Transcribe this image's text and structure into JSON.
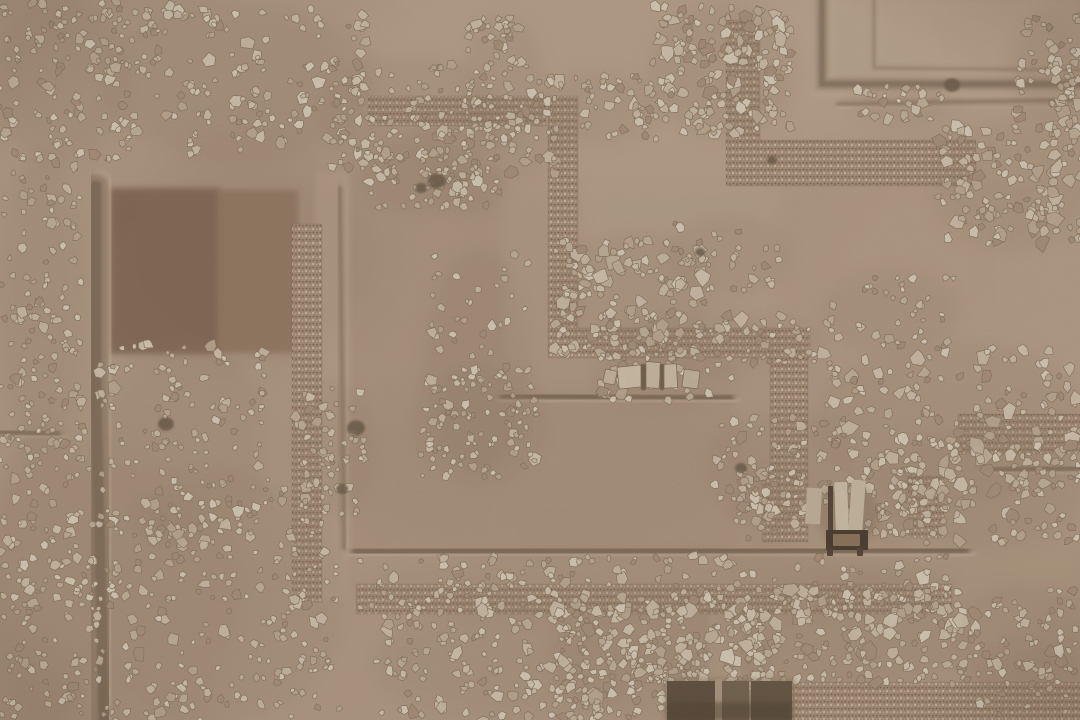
{
  "scene": {
    "description": "Aerial orthographic photograph of an archaeological excavation: tan earth, shallow trenches, pebble wall foundations, rubble fields, stone slabs, a small timber installation and a dark rectangular pit",
    "canvas": {
      "width": 1080,
      "height": 720
    },
    "palette": {
      "base": "#b59b84",
      "trench_dark": "#7c6450",
      "trench_core": "#6a5542",
      "trench_light": "#cbb296",
      "pebble_base": "#a68b72",
      "pebble_dark": "#8c7159",
      "pebble_light": "#cdb99e",
      "stone_stroke": "#857058",
      "dark_stone": "#6b5642",
      "pit_dark": "#584634",
      "wood_dark": "#3c2e1f"
    },
    "stone_palette": [
      "#d8c8b1",
      "#cfbda5",
      "#e0d2bc",
      "#c6b299",
      "#bfa98f",
      "#d2c0a8",
      "#a78d74"
    ],
    "tones": [
      {
        "cx": 650,
        "cy": 60,
        "rx": 300,
        "ry": 120,
        "c": "#c6ad93",
        "o": 0.5
      },
      {
        "cx": 180,
        "cy": 80,
        "rx": 200,
        "ry": 95,
        "c": "#b29880",
        "o": 0.5
      },
      {
        "cx": 540,
        "cy": 470,
        "rx": 220,
        "ry": 95,
        "c": "#a98e76",
        "o": 0.45
      },
      {
        "cx": 900,
        "cy": 620,
        "rx": 260,
        "ry": 120,
        "c": "#b09478",
        "o": 0.4
      },
      {
        "cx": 80,
        "cy": 600,
        "rx": 170,
        "ry": 150,
        "c": "#a78d75",
        "o": 0.5
      },
      {
        "cx": 1000,
        "cy": 300,
        "rx": 180,
        "ry": 140,
        "c": "#bda389",
        "o": 0.5
      },
      {
        "cx": 420,
        "cy": 650,
        "rx": 200,
        "ry": 90,
        "c": "#b79c82",
        "o": 0.4
      },
      {
        "cx": 250,
        "cy": 255,
        "rx": 130,
        "ry": 105,
        "c": "#8f735a",
        "o": 0.3
      },
      {
        "cx": 940,
        "cy": 40,
        "rx": 200,
        "ry": 80,
        "c": "#c3aa90",
        "o": 0.5
      }
    ],
    "patches": [
      {
        "x": 110,
        "y": 188,
        "w": 110,
        "h": 166,
        "c": "#75573f",
        "o": 0.85,
        "b": 3
      },
      {
        "x": 218,
        "y": 190,
        "w": 80,
        "h": 163,
        "c": "#8a6a4f",
        "o": 0.8,
        "b": 3
      },
      {
        "x": 820,
        "y": 0,
        "w": 260,
        "h": 88,
        "c": "#c2a98e",
        "o": 0.65,
        "b": 4
      },
      {
        "x": 968,
        "y": 84,
        "w": 112,
        "h": 100,
        "c": "#bfa58b",
        "o": 0.5,
        "b": 4
      },
      {
        "x": 350,
        "y": 170,
        "w": 154,
        "h": 384,
        "c": "#aa8f77",
        "o": 0.45,
        "b": 6
      },
      {
        "x": 502,
        "y": 394,
        "w": 234,
        "h": 160,
        "c": "#aa8f77",
        "o": 0.45,
        "b": 6
      },
      {
        "x": 316,
        "y": 172,
        "w": 34,
        "h": 428,
        "c": "#c0a78d",
        "o": 0.5,
        "b": 3
      },
      {
        "x": 708,
        "y": 606,
        "w": 34,
        "h": 74,
        "c": "#bfa58b",
        "o": 0.7,
        "b": 2
      },
      {
        "x": 358,
        "y": 556,
        "w": 370,
        "h": 28,
        "c": "#b89e85",
        "o": 0.5,
        "b": 3
      },
      {
        "x": 580,
        "y": 118,
        "w": 200,
        "h": 215,
        "c": "#bfa68c",
        "o": 0.5,
        "b": 10
      },
      {
        "x": 780,
        "y": 190,
        "w": 240,
        "h": 140,
        "c": "#b89e85",
        "o": 0.4,
        "b": 10
      }
    ],
    "trenches": [
      {
        "p": [
          [
            0,
            172
          ],
          [
            500,
            172
          ]
        ],
        "w": 20,
        "o": 0.6
      },
      {
        "p": [
          [
            96,
            186
          ],
          [
            96,
            400
          ],
          [
            104,
            720
          ]
        ],
        "w": 24,
        "o": 0.55
      },
      {
        "p": [
          [
            352,
            0
          ],
          [
            352,
            168
          ]
        ],
        "w": 16,
        "o": 0.5
      },
      {
        "p": [
          [
            340,
            188
          ],
          [
            344,
            548
          ]
        ],
        "w": 8,
        "o": 0.3
      },
      {
        "p": [
          [
            503,
            160
          ],
          [
            503,
            396
          ]
        ],
        "w": 10,
        "o": 0.4
      },
      {
        "p": [
          [
            503,
            396
          ],
          [
            730,
            398
          ]
        ],
        "w": 11,
        "o": 0.55
      },
      {
        "p": [
          [
            732,
            398
          ],
          [
            732,
            548
          ]
        ],
        "w": 11,
        "o": 0.5
      },
      {
        "p": [
          [
            356,
            552
          ],
          [
            965,
            550
          ]
        ],
        "w": 13,
        "o": 0.55
      },
      {
        "p": [
          [
            963,
            548
          ],
          [
            963,
            656
          ]
        ],
        "w": 13,
        "o": 0.5
      },
      {
        "p": [
          [
            985,
            470
          ],
          [
            1080,
            468
          ]
        ],
        "w": 10,
        "o": 0.45
      },
      {
        "p": [
          [
            822,
            0
          ],
          [
            822,
            84
          ],
          [
            1080,
            84
          ]
        ],
        "w": 12,
        "o": 0.45
      },
      {
        "p": [
          [
            874,
            0
          ],
          [
            874,
            68
          ],
          [
            1080,
            70
          ]
        ],
        "w": 5,
        "o": 0.25
      },
      {
        "p": [
          [
            838,
            104
          ],
          [
            1080,
            100
          ]
        ],
        "w": 7,
        "o": 0.3
      },
      {
        "p": [
          [
            0,
            432
          ],
          [
            58,
            434
          ]
        ],
        "w": 9,
        "o": 0.45
      },
      {
        "p": [
          [
            735,
            590
          ],
          [
            958,
            590
          ]
        ],
        "w": 8,
        "o": 0.4
      }
    ],
    "pebble_bands": [
      {
        "x": 368,
        "y": 96,
        "w": 178,
        "h": 30
      },
      {
        "x": 548,
        "y": 96,
        "w": 30,
        "h": 236
      },
      {
        "x": 548,
        "y": 328,
        "w": 262,
        "h": 30
      },
      {
        "x": 770,
        "y": 350,
        "w": 38,
        "h": 130
      },
      {
        "x": 292,
        "y": 224,
        "w": 30,
        "h": 378
      },
      {
        "x": 356,
        "y": 584,
        "w": 596,
        "h": 30
      },
      {
        "x": 726,
        "y": 20,
        "w": 34,
        "h": 126
      },
      {
        "x": 726,
        "y": 140,
        "w": 250,
        "h": 46
      },
      {
        "x": 958,
        "y": 414,
        "w": 122,
        "h": 40
      },
      {
        "x": 786,
        "y": 682,
        "w": 296,
        "h": 38
      },
      {
        "x": 908,
        "y": 476,
        "w": 36,
        "h": 62
      },
      {
        "x": 762,
        "y": 478,
        "w": 46,
        "h": 64
      }
    ],
    "rubble_clusters": [
      {
        "x": 0,
        "y": 0,
        "w": 120,
        "h": 160,
        "n": 110,
        "s1": 2.5,
        "s2": 7
      },
      {
        "x": 108,
        "y": 6,
        "w": 258,
        "h": 150,
        "n": 190,
        "s1": 2.5,
        "s2": 7.5
      },
      {
        "x": 0,
        "y": 158,
        "w": 82,
        "h": 292,
        "n": 130,
        "s1": 2.5,
        "s2": 7
      },
      {
        "x": 0,
        "y": 428,
        "w": 96,
        "h": 292,
        "n": 160,
        "s1": 2.5,
        "s2": 7
      },
      {
        "x": 98,
        "y": 344,
        "w": 168,
        "h": 198,
        "n": 140,
        "s1": 2.5,
        "s2": 7
      },
      {
        "x": 94,
        "y": 478,
        "w": 248,
        "h": 242,
        "n": 260,
        "s1": 2.5,
        "s2": 7
      },
      {
        "x": 328,
        "y": 60,
        "w": 168,
        "h": 110,
        "n": 110,
        "s1": 2.5,
        "s2": 7.5
      },
      {
        "x": 652,
        "y": 6,
        "w": 140,
        "h": 128,
        "n": 170,
        "s1": 3,
        "s2": 9
      },
      {
        "x": 468,
        "y": 18,
        "w": 72,
        "h": 128,
        "n": 60,
        "s1": 2.5,
        "s2": 7
      },
      {
        "x": 538,
        "y": 76,
        "w": 118,
        "h": 64,
        "n": 55,
        "s1": 2.5,
        "s2": 7
      },
      {
        "x": 412,
        "y": 110,
        "w": 145,
        "h": 64,
        "n": 65,
        "s1": 2.5,
        "s2": 7.5
      },
      {
        "x": 366,
        "y": 146,
        "w": 98,
        "h": 62,
        "n": 45,
        "s1": 2.5,
        "s2": 7
      },
      {
        "x": 556,
        "y": 240,
        "w": 148,
        "h": 114,
        "n": 150,
        "s1": 3,
        "s2": 9
      },
      {
        "x": 612,
        "y": 316,
        "w": 205,
        "h": 50,
        "n": 65,
        "s1": 2.5,
        "s2": 8
      },
      {
        "x": 430,
        "y": 252,
        "w": 98,
        "h": 218,
        "n": 60,
        "s1": 2.5,
        "s2": 7
      },
      {
        "x": 420,
        "y": 370,
        "w": 118,
        "h": 108,
        "n": 85,
        "s1": 2.5,
        "s2": 8
      },
      {
        "x": 596,
        "y": 354,
        "w": 140,
        "h": 48,
        "n": 45,
        "s1": 2.5,
        "s2": 7
      },
      {
        "x": 714,
        "y": 416,
        "w": 138,
        "h": 98,
        "n": 75,
        "s1": 2.5,
        "s2": 8
      },
      {
        "x": 818,
        "y": 348,
        "w": 264,
        "h": 148,
        "n": 170,
        "s1": 3,
        "s2": 9
      },
      {
        "x": 896,
        "y": 436,
        "w": 186,
        "h": 108,
        "n": 110,
        "s1": 3,
        "s2": 9
      },
      {
        "x": 936,
        "y": 126,
        "w": 148,
        "h": 118,
        "n": 140,
        "s1": 3,
        "s2": 9
      },
      {
        "x": 1016,
        "y": 16,
        "w": 64,
        "h": 108,
        "n": 65,
        "s1": 3,
        "s2": 8
      },
      {
        "x": 670,
        "y": 222,
        "w": 115,
        "h": 68,
        "n": 30,
        "s1": 2.5,
        "s2": 7
      },
      {
        "x": 360,
        "y": 556,
        "w": 598,
        "h": 60,
        "n": 180,
        "s1": 2.5,
        "s2": 8
      },
      {
        "x": 376,
        "y": 606,
        "w": 268,
        "h": 114,
        "n": 180,
        "s1": 2.5,
        "s2": 8
      },
      {
        "x": 556,
        "y": 596,
        "w": 208,
        "h": 124,
        "n": 210,
        "s1": 3,
        "s2": 9
      },
      {
        "x": 726,
        "y": 586,
        "w": 238,
        "h": 98,
        "n": 210,
        "s1": 3,
        "s2": 9
      },
      {
        "x": 956,
        "y": 586,
        "w": 124,
        "h": 94,
        "n": 55,
        "s1": 2.5,
        "s2": 7
      },
      {
        "x": 826,
        "y": 276,
        "w": 128,
        "h": 70,
        "n": 40,
        "s1": 2.5,
        "s2": 7
      },
      {
        "x": 296,
        "y": 386,
        "w": 70,
        "h": 128,
        "n": 55,
        "s1": 2.5,
        "s2": 7
      },
      {
        "x": 436,
        "y": 166,
        "w": 64,
        "h": 44,
        "n": 30,
        "s1": 2.5,
        "s2": 7
      },
      {
        "x": 856,
        "y": 86,
        "w": 88,
        "h": 34,
        "n": 26,
        "s1": 2.5,
        "s2": 6.5
      },
      {
        "x": 648,
        "y": 634,
        "w": 60,
        "h": 48,
        "n": 45,
        "s1": 2.5,
        "s2": 8
      },
      {
        "x": 976,
        "y": 650,
        "w": 106,
        "h": 64,
        "n": 36,
        "s1": 2.5,
        "s2": 7
      },
      {
        "x": 736,
        "y": 470,
        "w": 70,
        "h": 70,
        "n": 45,
        "s1": 2.5,
        "s2": 8
      },
      {
        "x": 866,
        "y": 470,
        "w": 50,
        "h": 70,
        "n": 40,
        "s1": 2.5,
        "s2": 8
      }
    ],
    "slabs": [
      {
        "x": 618,
        "y": 366,
        "w": 24,
        "h": 22,
        "r": -6,
        "c": "#d6c5ac"
      },
      {
        "x": 645,
        "y": 362,
        "w": 15,
        "h": 26,
        "r": 4,
        "c": "#cfbea5"
      },
      {
        "x": 663,
        "y": 364,
        "w": 14,
        "h": 24,
        "r": -3,
        "c": "#d3c2a8"
      },
      {
        "x": 683,
        "y": 370,
        "w": 16,
        "h": 18,
        "r": 8,
        "c": "#c8b79d"
      },
      {
        "x": 641,
        "y": 364,
        "w": 5,
        "h": 26,
        "r": 0,
        "c": "#6b563f"
      },
      {
        "x": 660,
        "y": 364,
        "w": 4,
        "h": 26,
        "r": 0,
        "c": "#6b563f"
      },
      {
        "x": 604,
        "y": 370,
        "w": 12,
        "h": 14,
        "r": 12,
        "c": "#cbb9a0"
      }
    ],
    "installation": {
      "shadow": {
        "cx": 848,
        "cy": 516,
        "rx": 30,
        "ry": 32
      },
      "parts": [
        {
          "x": 806,
          "y": 488,
          "w": 15,
          "h": 36,
          "r": 3,
          "c": "#c7b59c"
        },
        {
          "x": 835,
          "y": 482,
          "w": 13,
          "h": 50,
          "r": -2,
          "c": "#d4c3ab"
        },
        {
          "x": 850,
          "y": 480,
          "w": 14,
          "h": 52,
          "r": 4,
          "c": "#cebda3"
        },
        {
          "x": 828,
          "y": 486,
          "w": 5,
          "h": 46,
          "r": 0,
          "c": "#4a3828"
        },
        {
          "x": 826,
          "y": 530,
          "w": 42,
          "h": 20,
          "r": 0,
          "c": "#3c2e1f"
        },
        {
          "x": 833,
          "y": 534,
          "w": 27,
          "h": 12,
          "r": 0,
          "c": "#8b7156"
        },
        {
          "x": 827,
          "y": 548,
          "w": 6,
          "h": 8,
          "r": 0,
          "c": "#4a3828"
        },
        {
          "x": 857,
          "y": 548,
          "w": 6,
          "h": 8,
          "r": 0,
          "c": "#4a3828"
        }
      ]
    },
    "pit": [
      {
        "x": 664,
        "y": 678,
        "w": 132,
        "h": 42,
        "c": "#8a7158",
        "o": 0.45,
        "b": 2
      },
      {
        "x": 667,
        "y": 681,
        "w": 50,
        "h": 39,
        "c": "#584634",
        "o": 1,
        "b": 0
      },
      {
        "x": 719,
        "y": 681,
        "w": 30,
        "h": 39,
        "c": "#6f5b45",
        "o": 1,
        "b": 0
      },
      {
        "x": 751,
        "y": 681,
        "w": 41,
        "h": 39,
        "c": "#5f4c39",
        "o": 1,
        "b": 0
      },
      {
        "x": 715,
        "y": 679,
        "w": 7,
        "h": 41,
        "c": "#ad937a",
        "o": 1,
        "b": 0
      },
      {
        "x": 667,
        "y": 702,
        "w": 125,
        "h": 18,
        "c": "#463726",
        "o": 0.5,
        "b": 2
      }
    ],
    "dark_stones": [
      [
        437,
        181,
        9
      ],
      [
        421,
        188,
        6
      ],
      [
        356,
        428,
        9
      ],
      [
        342,
        489,
        6
      ],
      [
        166,
        424,
        8
      ],
      [
        952,
        85,
        8
      ],
      [
        741,
        468,
        6
      ],
      [
        700,
        252,
        5
      ],
      [
        772,
        160,
        5
      ]
    ],
    "grain": {
      "dark_opacity": 0.11,
      "light_opacity": 0.09,
      "mottle_opacity": 0.12
    }
  }
}
